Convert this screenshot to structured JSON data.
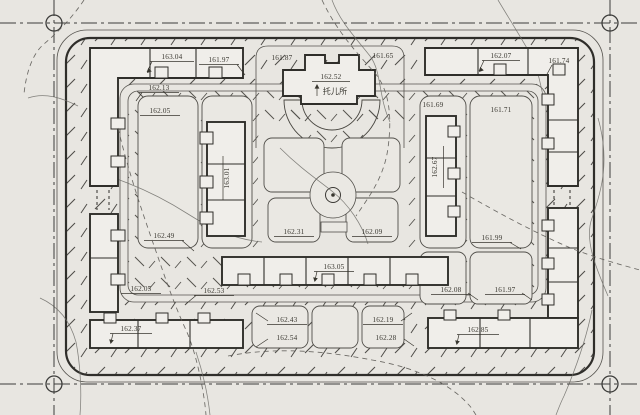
{
  "site_plan": {
    "nursery": {
      "name": "托儿所",
      "elevation": "162.52"
    },
    "buildings": {
      "inner_left": "163.01",
      "inner_right": "162.67",
      "bottom_center": "163.05",
      "bottom_left": "162.37",
      "bottom_right": "162.85"
    },
    "elevations": {
      "top_left_a": "163.04",
      "top_left_b": "161.97",
      "road_top_left": "162.13",
      "plot_left": "162.05",
      "top_center_a": "161.87",
      "top_center_b": "161.65",
      "top_right_a": "162.07",
      "top_right_b": "161.74",
      "plot_right_a": "161.69",
      "plot_right_b": "161.71",
      "left_mid": "162.49",
      "garden_left": "162.31",
      "garden_right": "162.09",
      "right_mid": "161.99",
      "road_bottom_a": "162.05",
      "road_bottom_b": "162.53",
      "plot_bottom_1a": "162.43",
      "plot_bottom_1b": "162.54",
      "plot_bottom_2a": "162.19",
      "plot_bottom_2b": "162.28",
      "plot_bottom_right_a": "162.08",
      "plot_bottom_right_b": "161.97"
    }
  }
}
